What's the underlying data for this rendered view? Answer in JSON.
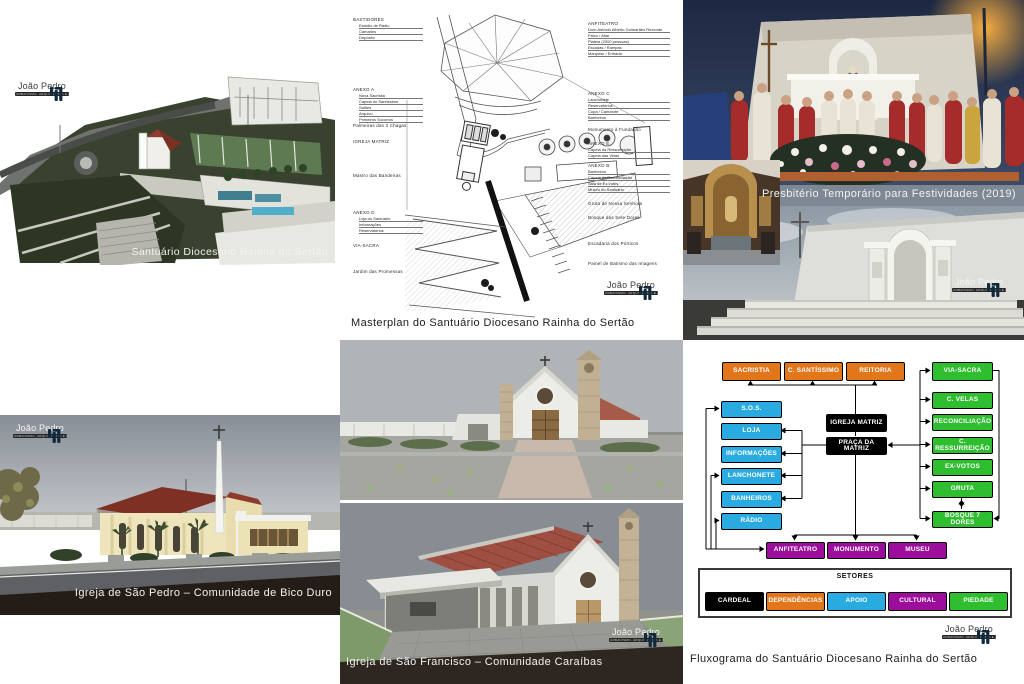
{
  "logo": {
    "name": "João Pedro",
    "tagline": "URBANISMO, ARQUITETURA E CONSULTORIA",
    "icon": "jp-bars-icon",
    "brand_blue": "#29a9e0"
  },
  "panels": {
    "aerial": {
      "caption": "Santuário Diocesano Rainha do Sertão"
    },
    "masterplan": {
      "caption": "Masterplan do Santuário Diocesano Rainha do Sertão",
      "left_labels": [
        {
          "title": "BASTIDORES",
          "items": [
            "Estúdio de Rádio",
            "Camarins",
            "Depósito"
          ]
        },
        {
          "title": "ANEXO A",
          "items": [
            "Nova Sacristia",
            "Capela do Santíssimo",
            "Salões",
            "Arquivo",
            "Primeiros Socorros"
          ]
        },
        {
          "title": "Palmeiras das 3 Chagas",
          "items": []
        },
        {
          "title": "IGREJA MATRIZ",
          "items": []
        },
        {
          "title": "Mastro das Bandeiras",
          "items": []
        },
        {
          "title": "ANEXO D",
          "items": [
            "Loja do Santuário",
            "Informações",
            "Reservatórios"
          ]
        },
        {
          "title": "VIA-SACRA",
          "items": []
        },
        {
          "title": "Jardim das Promessas",
          "items": []
        }
      ],
      "right_labels": [
        {
          "title": "ANFITEATRO",
          "items": [
            "Dom Antônio Alberto Guimarães Rezende",
            "Palco / Altar",
            "Plateia (2000 pessoas)",
            "Escadas / Rampas",
            "Marquise / Entrada"
          ]
        },
        {
          "title": "ANEXO C",
          "items": [
            "Lanchonete",
            "Reservatórios",
            "Copa / Camarote",
            "Banheiros"
          ]
        },
        {
          "title": "Monumento à Fundação",
          "items": []
        },
        {
          "title": "ANEXO E",
          "items": [
            "Capela da Ressurreição",
            "Capela das Velas"
          ]
        },
        {
          "title": "ANEXO B",
          "items": [
            "Banheiros",
            "Capela da Reconciliação",
            "Sala de Ex-votos",
            "Museu do Santuário"
          ]
        },
        {
          "title": "Gruta de Nossa Senhora",
          "items": []
        },
        {
          "title": "Bosque das Sete Dores",
          "items": []
        },
        {
          "title": "Escadaria dos Pórticos",
          "items": []
        },
        {
          "title": "Painel de Batismo das Imagens",
          "items": []
        }
      ]
    },
    "presbytery": {
      "caption": "Presbitério Temporário para Festividades (2019)"
    },
    "sao_pedro": {
      "caption": "Igreja de São Pedro – Comunidade de Bico Duro"
    },
    "sao_francisco": {
      "caption": "Igreja de São Francisco – Comunidade Caraíbas"
    },
    "flowchart": {
      "caption": "Fluxograma do Santuário Diocesano Rainha do Sertão",
      "colors": {
        "cardeal": "#000000",
        "dependencias": "#e2761b",
        "apoio": "#29abe2",
        "cultural": "#9c0d9c",
        "piedade": "#2fbe2f"
      },
      "nodes": {
        "sacristia": "SACRISTIA",
        "santissimo": "C. SANTÍSSIMO",
        "reitoria": "REITORIA",
        "sos": "S.O.S.",
        "loja": "LOJA",
        "informacoes": "INFORMAÇÕES",
        "lanchonete": "LANCHONETE",
        "banheiros": "BANHEIROS",
        "radio": "RÁDIO",
        "igreja": "IGREJA MATRIZ",
        "praca": "PRAÇA DA MATRIZ",
        "viasacra": "VIA-SACRA",
        "velas": "C. VELAS",
        "reconciliacao": "RECONCILIAÇÃO",
        "ressurreicao": "C. RESSURREIÇÃO",
        "exvotos": "EX-VOTOS",
        "gruta": "GRUTA",
        "bosque": "BOSQUE 7 DORES",
        "anfiteatro": "ANFITEATRO",
        "monumento": "MONUMENTO",
        "museu": "MUSEU"
      },
      "edges": [
        "IGREJA MATRIZ → SACRISTIA",
        "IGREJA MATRIZ → C. SANTÍSSIMO",
        "IGREJA MATRIZ → REITORIA",
        "IGREJA MATRIZ — PRAÇA DA MATRIZ",
        "PRAÇA DA MATRIZ → LOJA",
        "PRAÇA DA MATRIZ → INFORMAÇÕES",
        "PRAÇA DA MATRIZ → LANCHONETE",
        "PRAÇA DA MATRIZ → BANHEIROS",
        "PRAÇA DA MATRIZ → ANFITEATRO",
        "PRAÇA DA MATRIZ → MONUMENTO",
        "PRAÇA DA MATRIZ → MUSEU",
        "PIEDADE (bus) → PRAÇA DA MATRIZ",
        "bus → VIA-SACRA / C. VELAS / RECONCILIAÇÃO / C. RESSURREIÇÃO / EX-VOTOS / GRUTA / BOSQUE 7 DORES",
        "GRUTA ↔ BOSQUE 7 DORES",
        "ANFITEATRO loop → S.O.S. / LANCHONETE / RÁDIO"
      ],
      "legend": {
        "title": "SETORES",
        "items": [
          {
            "label": "CARDEAL",
            "color": "#000000"
          },
          {
            "label": "DEPENDÊNCIAS",
            "color": "#e2761b"
          },
          {
            "label": "APOIO",
            "color": "#29abe2"
          },
          {
            "label": "CULTURAL",
            "color": "#9c0d9c"
          },
          {
            "label": "PIEDADE",
            "color": "#2fbe2f"
          }
        ]
      }
    }
  }
}
